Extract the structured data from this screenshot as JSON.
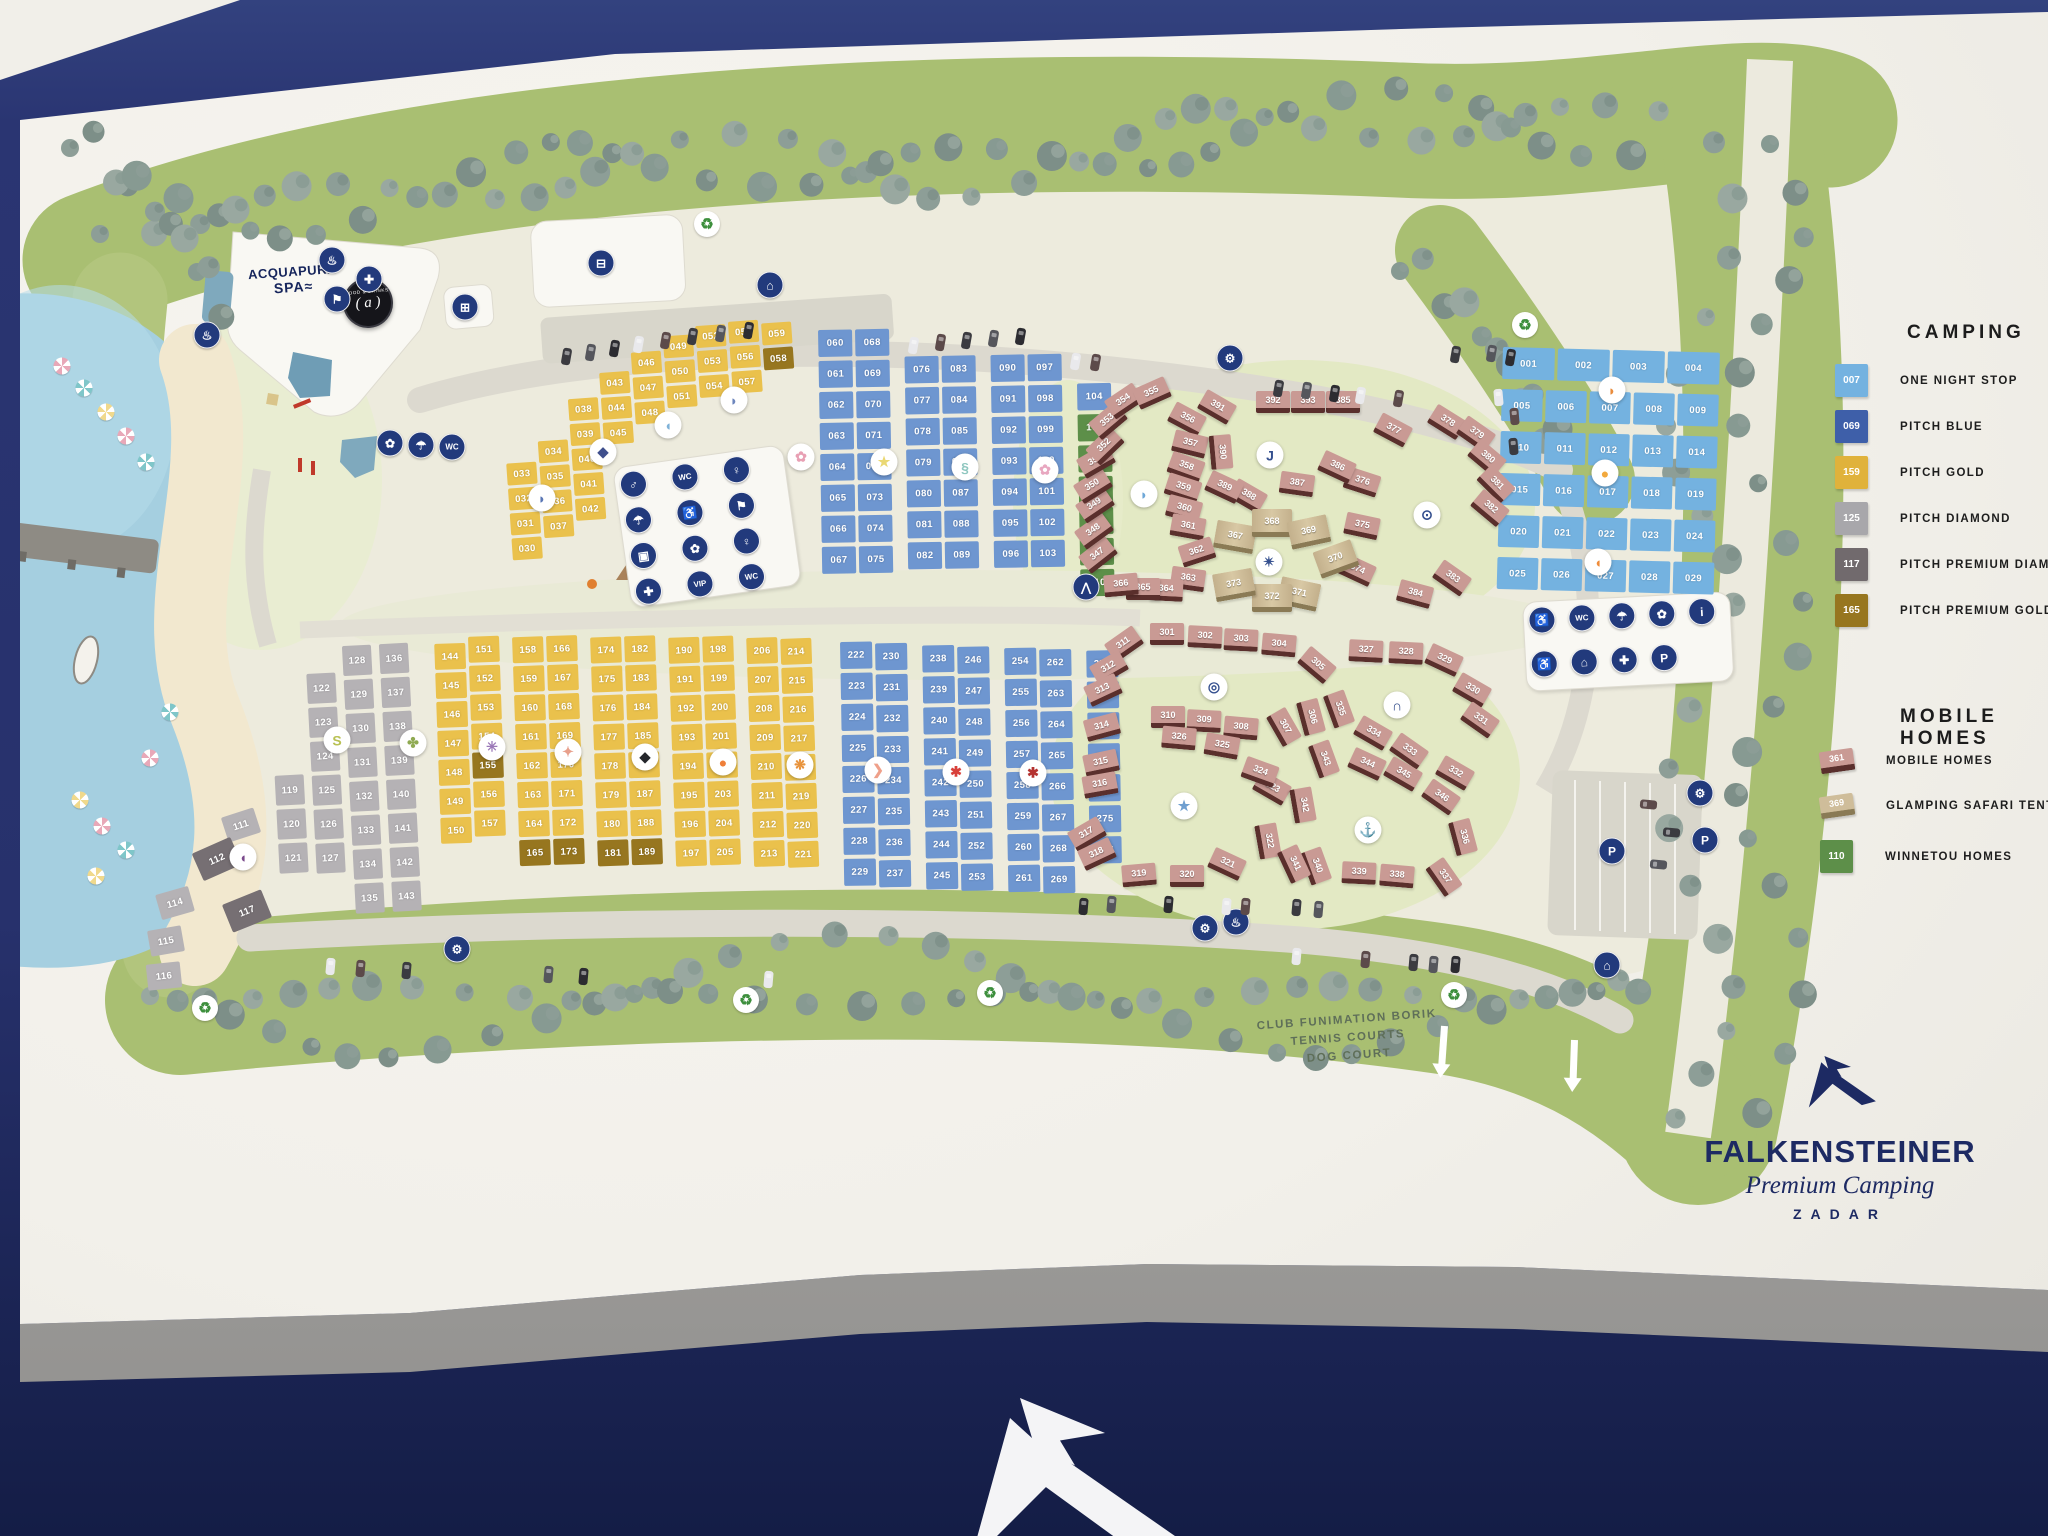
{
  "brand": {
    "name": "FALKENSTEINER",
    "tagline": "Premium Camping",
    "city": "ZADAR"
  },
  "legend_camping": {
    "title": "CAMPING",
    "items": [
      {
        "num": "007",
        "label": "ONE NIGHT STOP",
        "color": "#74b2e0"
      },
      {
        "num": "069",
        "label": "PITCH BLUE",
        "color": "#3e5fa9"
      },
      {
        "num": "159",
        "label": "PITCH GOLD",
        "color": "#e0b23b"
      },
      {
        "num": "125",
        "label": "PITCH DIAMOND",
        "color": "#a8a7ab"
      },
      {
        "num": "117",
        "label": "PITCH PREMIUM DIAMOND",
        "color": "#716a6d"
      },
      {
        "num": "165",
        "label": "PITCH PREMIUM GOLD",
        "color": "#97761f"
      }
    ]
  },
  "legend_mobile": {
    "title": "MOBILE HOMES",
    "items": [
      {
        "num": "361",
        "label": "MOBILE HOMES",
        "type": "pink-house",
        "color": "#c99a94"
      },
      {
        "num": "369",
        "label": "GLAMPING SAFARI TENT",
        "type": "beige-house",
        "color": "#cfbd9a"
      },
      {
        "num": "110",
        "label": "WINNETOU HOMES",
        "type": "green-square",
        "color": "#5d8f49"
      }
    ]
  },
  "labels": {
    "spa_line1": "ACQUAPURA",
    "spa_line2": "SPA≈",
    "food_top": "FOOD & DRINKS",
    "food_center": "( a )",
    "club_lines": [
      "CLUB FUNIMATION BORIK",
      "TENNIS COURTS",
      "DOG COURT"
    ]
  },
  "pitch_blocks": {
    "premium_gold_nums": [
      "058",
      "155",
      "165",
      "173",
      "181",
      "189"
    ],
    "premium_diamond_nums": [
      "112",
      "117"
    ],
    "one_night_rows": [
      [
        "001",
        "002",
        "003",
        "004"
      ],
      [
        "005",
        "006",
        "007",
        "008",
        "009"
      ],
      [
        "010",
        "011",
        "012",
        "013",
        "014"
      ],
      [
        "015",
        "016",
        "017",
        "018",
        "019"
      ],
      [
        "020",
        "021",
        "022",
        "023",
        "024"
      ],
      [
        "025",
        "026",
        "027",
        "028",
        "029"
      ]
    ],
    "gold_top_cols": [
      [
        "033",
        "032",
        "031",
        "030"
      ],
      [
        "034",
        "035",
        "036",
        "037"
      ],
      [
        "038",
        "039",
        "040",
        "041",
        "042"
      ],
      [
        "043",
        "044",
        "045"
      ],
      [
        "046",
        "047",
        "048"
      ],
      [
        "049",
        "050",
        "051"
      ],
      [
        "052",
        "053",
        "054"
      ],
      [
        "055",
        "056",
        "057"
      ],
      [
        "059",
        "058"
      ]
    ],
    "blue_top_cols": [
      [
        "060",
        "061",
        "062",
        "063",
        "064",
        "065",
        "066",
        "067"
      ],
      [
        "068",
        "069",
        "070",
        "071",
        "072",
        "073",
        "074",
        "075"
      ],
      [
        "076",
        "077",
        "078",
        "079",
        "080",
        "081",
        "082"
      ],
      [
        "083",
        "084",
        "085",
        "086",
        "087",
        "088",
        "089"
      ],
      [
        "090",
        "091",
        "092",
        "093",
        "094",
        "095",
        "096"
      ],
      [
        "097",
        "098",
        "099",
        "100",
        "101",
        "102",
        "103"
      ],
      [
        "104",
        "105",
        "106",
        "107",
        "108",
        "109",
        "110"
      ]
    ],
    "winnetou_green_nums": [
      "105",
      "106",
      "107",
      "108",
      "109",
      "110"
    ],
    "diamond_cols": [
      [
        "119",
        "120",
        "121"
      ],
      [
        "122",
        "123",
        "124",
        "125",
        "126",
        "127"
      ],
      [
        "128",
        "129",
        "130",
        "131",
        "132",
        "133",
        "134",
        "135"
      ],
      [
        "136",
        "137",
        "138",
        "139",
        "140",
        "141",
        "142",
        "143"
      ]
    ],
    "diamond_loose": [
      [
        "111",
        224,
        812,
        -18,
        0
      ],
      [
        "112",
        196,
        844,
        -24,
        1
      ],
      [
        "114",
        158,
        890,
        -16,
        0
      ],
      [
        "115",
        149,
        928,
        -10,
        0
      ],
      [
        "116",
        147,
        963,
        -6,
        0
      ],
      [
        "117",
        226,
        896,
        -22,
        1
      ]
    ],
    "gold_bottom_cols": [
      [
        "144",
        "145",
        "146",
        "147",
        "148",
        "149",
        "150"
      ],
      [
        "151",
        "152",
        "153",
        "154",
        "155",
        "156",
        "157"
      ],
      [
        "158",
        "159",
        "160",
        "161",
        "162",
        "163",
        "164",
        "165"
      ],
      [
        "166",
        "167",
        "168",
        "169",
        "170",
        "171",
        "172",
        "173"
      ],
      [
        "174",
        "175",
        "176",
        "177",
        "178",
        "179",
        "180",
        "181"
      ],
      [
        "182",
        "183",
        "184",
        "185",
        "186",
        "187",
        "188",
        "189"
      ],
      [
        "190",
        "191",
        "192",
        "193",
        "194",
        "195",
        "196",
        "197"
      ],
      [
        "198",
        "199",
        "200",
        "201",
        "202",
        "203",
        "204",
        "205"
      ],
      [
        "206",
        "207",
        "208",
        "209",
        "210",
        "211",
        "212",
        "213"
      ],
      [
        "214",
        "215",
        "216",
        "217",
        "218",
        "219",
        "220",
        "221"
      ]
    ],
    "blue_bottom_cols": [
      [
        "222",
        "223",
        "224",
        "225",
        "226",
        "227",
        "228",
        "229"
      ],
      [
        "230",
        "231",
        "232",
        "233",
        "234",
        "235",
        "236",
        "237"
      ],
      [
        "238",
        "239",
        "240",
        "241",
        "242",
        "243",
        "244",
        "245"
      ],
      [
        "246",
        "247",
        "248",
        "249",
        "250",
        "251",
        "252",
        "253"
      ],
      [
        "254",
        "255",
        "256",
        "257",
        "258",
        "259",
        "260",
        "261"
      ],
      [
        "262",
        "263",
        "264",
        "265",
        "266",
        "267",
        "268",
        "269"
      ],
      [
        "270",
        "271",
        "272",
        "273",
        "274",
        "275",
        "276"
      ]
    ]
  },
  "mobile_homes": {
    "top_pink": [
      [
        "347",
        1098,
        557,
        -38
      ],
      [
        "348",
        1094,
        533,
        -36
      ],
      [
        "349",
        1095,
        507,
        -34
      ],
      [
        "350",
        1093,
        488,
        -32
      ],
      [
        "351",
        1096,
        463,
        -30
      ],
      [
        "352",
        1105,
        448,
        -44
      ],
      [
        "353",
        1108,
        423,
        -40
      ],
      [
        "354",
        1124,
        403,
        -34
      ],
      [
        "355",
        1152,
        395,
        -24
      ],
      [
        "356",
        1187,
        421,
        28
      ],
      [
        "357",
        1190,
        446,
        14
      ],
      [
        "358",
        1186,
        469,
        20
      ],
      [
        "359",
        1183,
        490,
        18
      ],
      [
        "360",
        1184,
        511,
        15
      ],
      [
        "361",
        1188,
        529,
        10
      ],
      [
        "362",
        1197,
        554,
        -18
      ],
      [
        "363",
        1188,
        581,
        8
      ],
      [
        "364",
        1166,
        592,
        3
      ],
      [
        "365",
        1143,
        591,
        0
      ],
      [
        "366",
        1121,
        587,
        -5
      ],
      [
        "374",
        1357,
        572,
        25
      ],
      [
        "375",
        1362,
        528,
        12
      ],
      [
        "376",
        1362,
        484,
        18
      ],
      [
        "377",
        1393,
        432,
        28
      ],
      [
        "378",
        1447,
        424,
        32
      ],
      [
        "379",
        1476,
        436,
        35
      ],
      [
        "380",
        1487,
        460,
        40
      ],
      [
        "381",
        1496,
        486,
        45
      ],
      [
        "382",
        1490,
        510,
        40
      ],
      [
        "383",
        1452,
        580,
        35
      ],
      [
        "384",
        1415,
        596,
        15
      ],
      [
        "385",
        1343,
        404,
        0
      ],
      [
        "386",
        1337,
        469,
        25
      ],
      [
        "387",
        1297,
        486,
        8
      ],
      [
        "388",
        1248,
        498,
        30
      ],
      [
        "389",
        1224,
        489,
        25
      ],
      [
        "390",
        1221,
        454,
        85
      ],
      [
        "391",
        1217,
        409,
        30
      ],
      [
        "392",
        1273,
        404,
        0
      ],
      [
        "393",
        1308,
        404,
        0
      ]
    ],
    "glamping": [
      [
        "367",
        1232,
        536,
        10
      ],
      [
        "368",
        1269,
        522,
        0
      ],
      [
        "369",
        1306,
        531,
        -12
      ],
      [
        "370",
        1333,
        558,
        -20
      ],
      [
        "371",
        1296,
        593,
        12
      ],
      [
        "372",
        1269,
        597,
        0
      ],
      [
        "373",
        1231,
        584,
        -10
      ]
    ],
    "bottom_pink": [
      [
        "301",
        1167,
        636,
        0
      ],
      [
        "302",
        1205,
        639,
        3
      ],
      [
        "303",
        1241,
        642,
        3
      ],
      [
        "304",
        1279,
        647,
        5
      ],
      [
        "305",
        1317,
        667,
        40
      ],
      [
        "306",
        1311,
        719,
        75
      ],
      [
        "307",
        1284,
        729,
        60
      ],
      [
        "308",
        1241,
        730,
        5
      ],
      [
        "309",
        1204,
        723,
        3
      ],
      [
        "310",
        1168,
        719,
        0
      ],
      [
        "311",
        1124,
        646,
        -35
      ],
      [
        "312",
        1109,
        670,
        -30
      ],
      [
        "313",
        1103,
        692,
        -25
      ],
      [
        "314",
        1102,
        729,
        -15
      ],
      [
        "315",
        1101,
        765,
        -12
      ],
      [
        "316",
        1100,
        787,
        -10
      ],
      [
        "317",
        1087,
        836,
        -30
      ],
      [
        "318",
        1097,
        856,
        -25
      ],
      [
        "319",
        1139,
        877,
        -5
      ],
      [
        "320",
        1187,
        878,
        0
      ],
      [
        "321",
        1227,
        866,
        25
      ],
      [
        "322",
        1268,
        843,
        80
      ],
      [
        "323",
        1272,
        790,
        30
      ],
      [
        "324",
        1260,
        774,
        20
      ],
      [
        "325",
        1222,
        748,
        10
      ],
      [
        "326",
        1179,
        740,
        5
      ],
      [
        "327",
        1366,
        653,
        3
      ],
      [
        "328",
        1406,
        655,
        3
      ],
      [
        "329",
        1444,
        662,
        25
      ],
      [
        "330",
        1472,
        692,
        30
      ],
      [
        "331",
        1480,
        722,
        35
      ],
      [
        "332",
        1455,
        775,
        30
      ],
      [
        "333",
        1409,
        753,
        35
      ],
      [
        "334",
        1373,
        735,
        30
      ],
      [
        "335",
        1339,
        711,
        70
      ],
      [
        "336",
        1463,
        839,
        75
      ],
      [
        "337",
        1444,
        879,
        55
      ],
      [
        "338",
        1397,
        878,
        5
      ],
      [
        "339",
        1359,
        875,
        3
      ],
      [
        "340",
        1316,
        868,
        70
      ],
      [
        "341",
        1294,
        866,
        65
      ],
      [
        "342",
        1303,
        807,
        80
      ],
      [
        "343",
        1324,
        761,
        70
      ],
      [
        "344",
        1367,
        766,
        25
      ],
      [
        "345",
        1403,
        776,
        30
      ],
      [
        "346",
        1441,
        799,
        35
      ]
    ]
  },
  "markers": [
    {
      "name": "clownfish-marker",
      "glyph": "◗",
      "color": "#e98c3c",
      "x": 1612,
      "y": 390
    },
    {
      "name": "goldfish-marker",
      "glyph": "●",
      "color": "#f2a93e",
      "x": 1605,
      "y": 473
    },
    {
      "name": "orangefish-marker",
      "glyph": "◖",
      "color": "#ef8c3a",
      "x": 1598,
      "y": 562
    },
    {
      "name": "dolphin-marker",
      "glyph": "◗",
      "color": "#5a77b5",
      "x": 542,
      "y": 498
    },
    {
      "name": "stingray-marker",
      "glyph": "◆",
      "color": "#3f4f8c",
      "x": 603,
      "y": 452
    },
    {
      "name": "whale-marker",
      "glyph": "◖",
      "color": "#7fb2d8",
      "x": 668,
      "y": 425
    },
    {
      "name": "dolphin2-marker",
      "glyph": "◗",
      "color": "#6d86bd",
      "x": 734,
      "y": 400
    },
    {
      "name": "jellyfish-marker",
      "glyph": "✿",
      "color": "#e8a0b4",
      "x": 801,
      "y": 457
    },
    {
      "name": "starfish-marker",
      "glyph": "★",
      "color": "#ead873",
      "x": 884,
      "y": 462
    },
    {
      "name": "seahorse-marker",
      "glyph": "§",
      "color": "#8fc7c0",
      "x": 965,
      "y": 467
    },
    {
      "name": "anemone-marker",
      "glyph": "✿",
      "color": "#e8a7c0",
      "x": 1045,
      "y": 470
    },
    {
      "name": "eel-marker",
      "glyph": "S",
      "color": "#b9c153",
      "x": 337,
      "y": 740
    },
    {
      "name": "turtle-marker",
      "glyph": "✤",
      "color": "#8faa52",
      "x": 413,
      "y": 743
    },
    {
      "name": "purplefish-marker",
      "glyph": "◖",
      "color": "#7b4a8c",
      "x": 243,
      "y": 857
    },
    {
      "name": "octopus-marker",
      "glyph": "✳",
      "color": "#9b79b8",
      "x": 492,
      "y": 747
    },
    {
      "name": "squid-marker",
      "glyph": "✦",
      "color": "#e8a08c",
      "x": 568,
      "y": 752
    },
    {
      "name": "orca-marker",
      "glyph": "◆",
      "color": "#24262b",
      "x": 645,
      "y": 757
    },
    {
      "name": "nemo-marker",
      "glyph": "●",
      "color": "#ef7f3a",
      "x": 723,
      "y": 762
    },
    {
      "name": "hermit-crab-marker",
      "glyph": "❋",
      "color": "#e8933c",
      "x": 800,
      "y": 765
    },
    {
      "name": "shrimp-marker",
      "glyph": "❯",
      "color": "#efa08a",
      "x": 878,
      "y": 770
    },
    {
      "name": "crab-marker",
      "glyph": "✱",
      "color": "#d8403a",
      "x": 956,
      "y": 772
    },
    {
      "name": "lobster-marker",
      "glyph": "✱",
      "color": "#b43230",
      "x": 1033,
      "y": 773
    },
    {
      "name": "hook-marker",
      "glyph": "J",
      "color": "#35508f",
      "x": 1270,
      "y": 455
    },
    {
      "name": "bluefish-marker",
      "glyph": "◗",
      "color": "#6fa8d8",
      "x": 1144,
      "y": 494
    },
    {
      "name": "compass-marker",
      "glyph": "✴",
      "color": "#35508f",
      "x": 1269,
      "y": 562
    },
    {
      "name": "shuttle-marker",
      "glyph": "⊙",
      "color": "#35508f",
      "x": 1427,
      "y": 515
    },
    {
      "name": "lifering-marker",
      "glyph": "◎",
      "color": "#35508f",
      "x": 1214,
      "y": 687
    },
    {
      "name": "shell-marker",
      "glyph": "∩",
      "color": "#2c4788",
      "x": 1397,
      "y": 705
    },
    {
      "name": "bluestar-marker",
      "glyph": "★",
      "color": "#6f9fd0",
      "x": 1184,
      "y": 806
    },
    {
      "name": "anchor-marker",
      "glyph": "⚓",
      "color": "#1f3a78",
      "x": 1368,
      "y": 830
    }
  ],
  "facility_icons": [
    {
      "name": "spa-lounger-icon",
      "glyph": "♨",
      "x": 207,
      "y": 335
    },
    {
      "name": "massage-icon",
      "glyph": "♨",
      "x": 332,
      "y": 260
    },
    {
      "name": "first-aid-icon",
      "glyph": "✚",
      "x": 369,
      "y": 279
    },
    {
      "name": "fitness-icon",
      "glyph": "⚑",
      "x": 337,
      "y": 299
    },
    {
      "name": "shop-icon",
      "glyph": "⊞",
      "x": 465,
      "y": 307
    },
    {
      "name": "cart-icon",
      "glyph": "⊟",
      "x": 601,
      "y": 263
    },
    {
      "name": "reception-icon",
      "glyph": "⌂",
      "x": 770,
      "y": 285
    },
    {
      "name": "service-icon",
      "glyph": "⚙",
      "x": 1230,
      "y": 358
    },
    {
      "name": "baby-room-icon",
      "glyph": "✿",
      "x": 390,
      "y": 443
    },
    {
      "name": "shower-icon",
      "glyph": "☂",
      "x": 421,
      "y": 445
    },
    {
      "name": "wc-icon",
      "glyph": "WC",
      "x": 452,
      "y": 447
    },
    {
      "name": "tent-pitch-icon",
      "glyph": "⋀",
      "x": 1086,
      "y": 587
    },
    {
      "name": "parking-icon",
      "glyph": "P",
      "x": 1612,
      "y": 851
    },
    {
      "name": "caravan-icon",
      "glyph": "⌂",
      "x": 1607,
      "y": 965
    },
    {
      "name": "car-service-icon",
      "glyph": "⚙",
      "x": 1700,
      "y": 793
    },
    {
      "name": "car-rental-icon",
      "glyph": "P",
      "x": 1705,
      "y": 840
    },
    {
      "name": "car-wash-icon",
      "glyph": "⚙",
      "x": 1205,
      "y": 928
    },
    {
      "name": "sauna-icon",
      "glyph": "♨",
      "x": 1236,
      "y": 922
    },
    {
      "name": "workshop-icon",
      "glyph": "⚙",
      "x": 457,
      "y": 949
    }
  ],
  "building_icons": {
    "sanitary": [
      "♂",
      "WC",
      "♀",
      "☂",
      "♿",
      "⚑",
      "▣",
      "✿",
      "♀",
      "✚",
      "VIP",
      "WC"
    ],
    "services": [
      "♿",
      "WC",
      "☂",
      "✿",
      "i",
      "♿",
      "⌂",
      "✚",
      "P"
    ]
  },
  "recycle_points": [
    [
      707,
      224
    ],
    [
      1525,
      325
    ],
    [
      205,
      1008
    ],
    [
      746,
      1000
    ],
    [
      990,
      993
    ],
    [
      1454,
      995
    ]
  ]
}
